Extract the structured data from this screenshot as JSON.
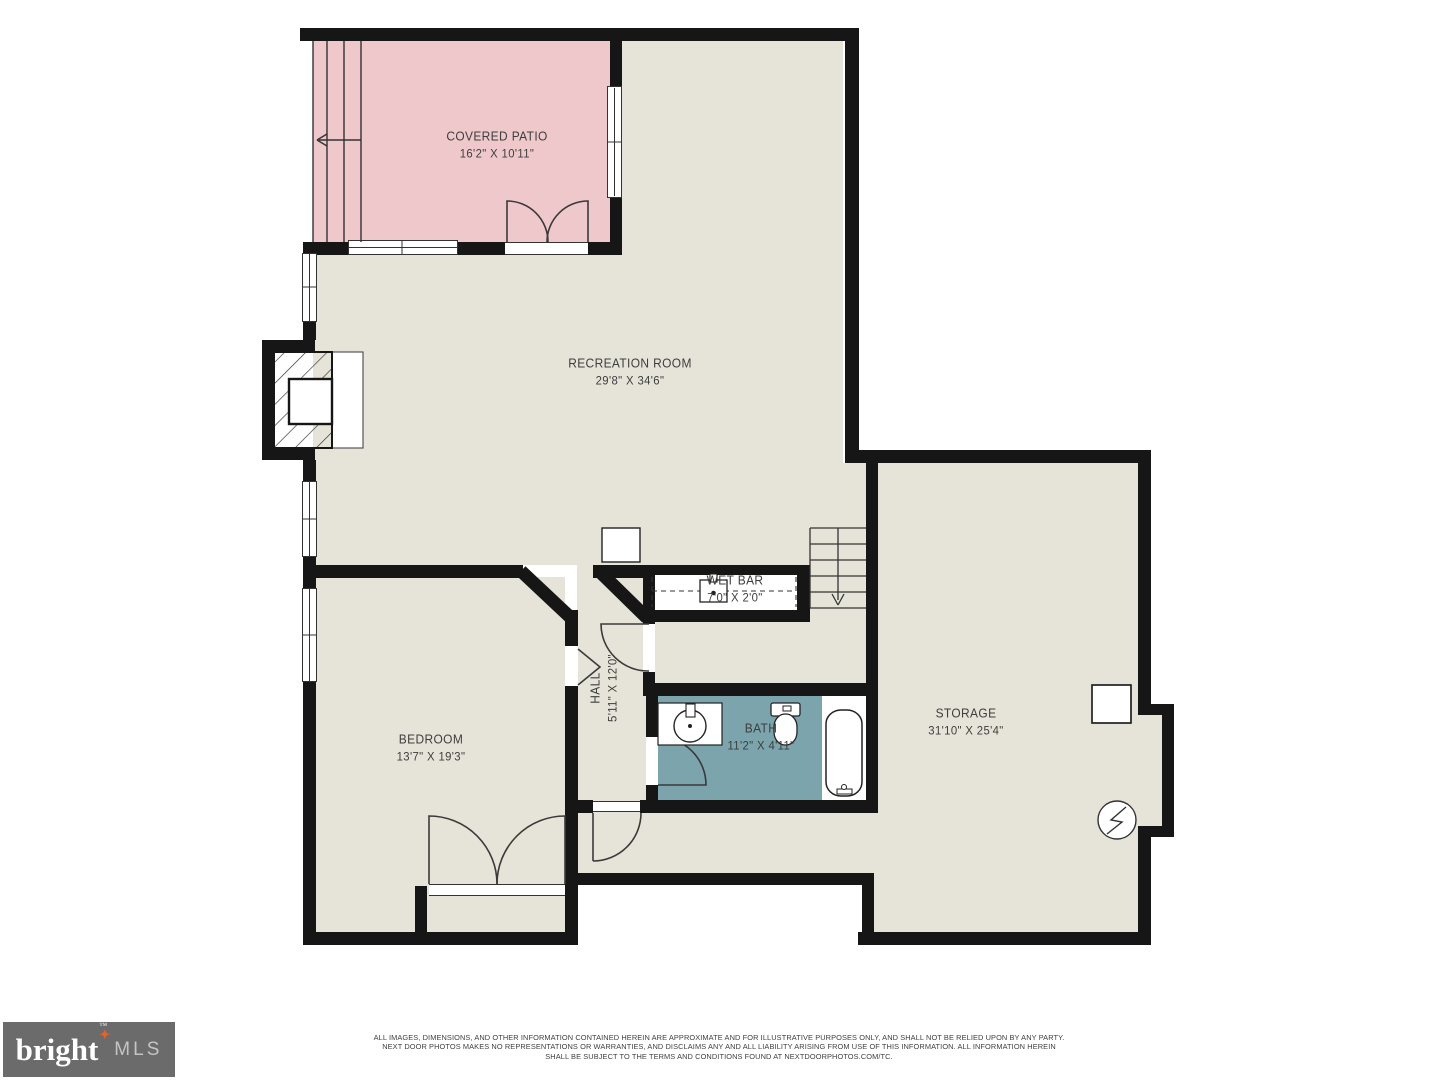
{
  "plan": {
    "rooms": {
      "covered_patio": {
        "name": "COVERED PATIO",
        "dims": "16'2\" X 10'11\""
      },
      "recreation_room": {
        "name": "RECREATION ROOM",
        "dims": "29'8\" X 34'6\""
      },
      "wet_bar": {
        "name": "WET BAR",
        "dims": "7'0\" X 2'0\""
      },
      "hall": {
        "name": "HALL",
        "dims": "5'11\" X 12'0\""
      },
      "bedroom": {
        "name": "BEDROOM",
        "dims": "13'7\" X 19'3\""
      },
      "bath": {
        "name": "BATH",
        "dims": "11'2\" X 4'11\""
      },
      "storage": {
        "name": "STORAGE",
        "dims": "31'10\" X 25'4\""
      }
    },
    "symbols": [
      "stairs-down-arrow",
      "patio-steps-exit-arrow",
      "fireplace",
      "wet-bar-sink",
      "bath-sink",
      "toilet",
      "bathtub",
      "electrical-panel",
      "utility-box",
      "door-swing-arcs",
      "window-glazing"
    ]
  },
  "footer": {
    "logo": {
      "brand": "bright",
      "tm": "™",
      "star": "✦",
      "suffix": "MLS"
    },
    "disclaimer_lines": [
      "ALL IMAGES, DIMENSIONS, AND OTHER INFORMATION CONTAINED HEREIN ARE APPROXIMATE AND FOR ILLUSTRATIVE PURPOSES ONLY, AND SHALL NOT BE RELIED UPON BY ANY PARTY.",
      "NEXT DOOR PHOTOS MAKES NO REPRESENTATIONS OR WARRANTIES, AND DISCLAIMS ANY AND ALL LIABILITY ARISING FROM USE OF THIS INFORMATION. ALL INFORMATION HEREIN",
      "SHALL BE SUBJECT TO THE TERMS AND CONDITIONS FOUND AT NEXTDOORPHOTOS.COM/TC."
    ]
  },
  "colors": {
    "floor": "#e6e4d9",
    "patio": "#efc8cb",
    "bath": "#7ba4ad",
    "wall": "#161616",
    "logo_bg": "#6b6b6b",
    "logo_star": "#e8612c"
  }
}
